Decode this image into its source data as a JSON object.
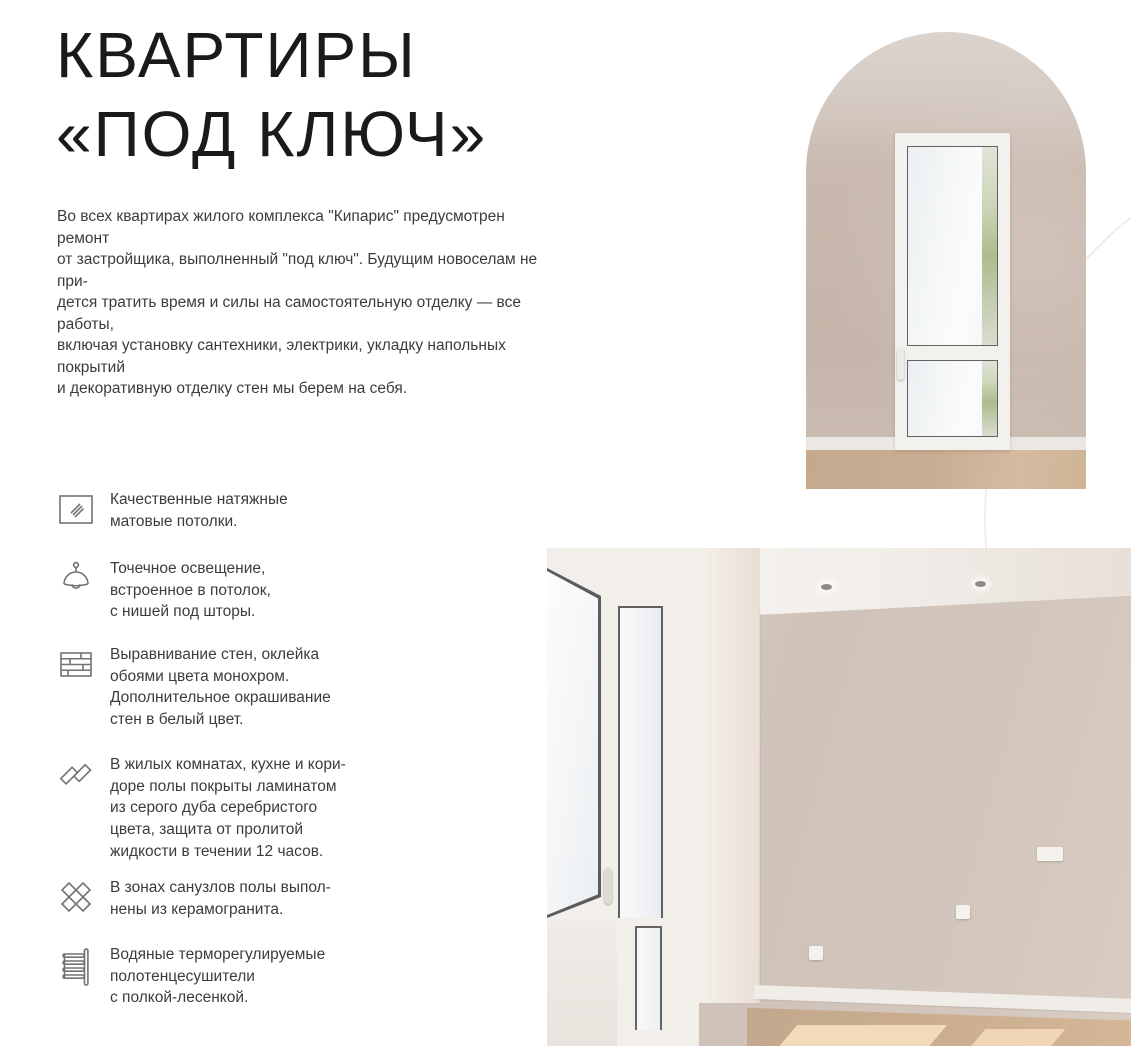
{
  "header": {
    "title_line1": "КВАРТИРЫ",
    "title_line2": "«ПОД КЛЮЧ»",
    "intro": "Во всех квартирах жилого комплекса \"Кипарис\" предусмотрен ремонт\nот застройщика, выполненный \"под ключ\". Будущим новоселам не при-\nдется тратить время и силы на самостоятельную отделку — все работы,\nвключая установку сантехники, электрики, укладку напольных покрытий\nи декоративную отделку стен мы берем на себя."
  },
  "features": [
    {
      "icon": "stretch-ceiling-icon",
      "text": "Качественные натяжные\nматовые потолки."
    },
    {
      "icon": "pendant-lamp-icon",
      "text": "Точечное освещение,\nвстроенное в потолок,\nс нишей под шторы."
    },
    {
      "icon": "brick-wall-icon",
      "text": "Выравнивание стен, оклейка\nобоями цвета монохром.\nДополнительное окрашивание\nстен в белый цвет."
    },
    {
      "icon": "laminate-planks-icon",
      "text": "В жилых комнатах, кухне и кори-\nдоре полы покрыты ламинатом\nиз серого дуба серебристого\nцвета, защита от пролитой\nжидкости в течении 12 часов."
    },
    {
      "icon": "ceramic-tiles-icon",
      "text": "В зонах санузлов полы выпол-\nнены из керамогранита."
    },
    {
      "icon": "towel-rail-icon",
      "text": "Водяные терморегулируемые\nполотенцесушители\nс полкой-лесенкой."
    }
  ],
  "photos": {
    "arch": "arched-opening-balcony-door-photo",
    "room": "empty-renovated-room-photo"
  },
  "colors": {
    "title_text": "#1a1a1a",
    "body_text": "#3c3c3c",
    "icon_stroke": "#737373",
    "wall_taupe": "#c9b9ae",
    "wall_beige": "#d2c5bc",
    "floor_wood": "#c9ad92",
    "decor_circle": "#f1eeea"
  }
}
